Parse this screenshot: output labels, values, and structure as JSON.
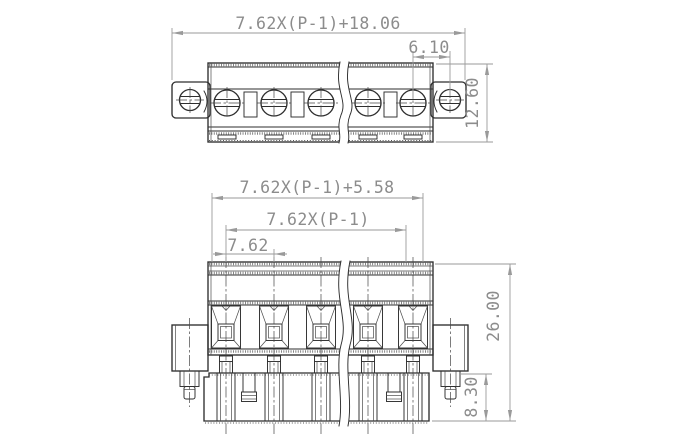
{
  "drawing": {
    "title": "pluggable terminal block connector - dimensional drawing",
    "colors": {
      "line": "#2e2e2e",
      "dim_line": "#9a9a9a",
      "dim_text": "#8c8c8c",
      "background": "#ffffff"
    },
    "top_view": {
      "poles_visible": 5,
      "mount_ears": 2,
      "dims": {
        "overall_width": "7.62X(P-1)+18.06",
        "mount_screw_offset": "6.10",
        "body_depth": "12.60"
      }
    },
    "front_view": {
      "poles_visible": 5,
      "dims": {
        "body_width": "7.62X(P-1)+5.58",
        "pole_span": "7.62X(P-1)",
        "pitch": "7.62",
        "overall_height": "26.00",
        "plug_height": "8.30"
      }
    }
  }
}
